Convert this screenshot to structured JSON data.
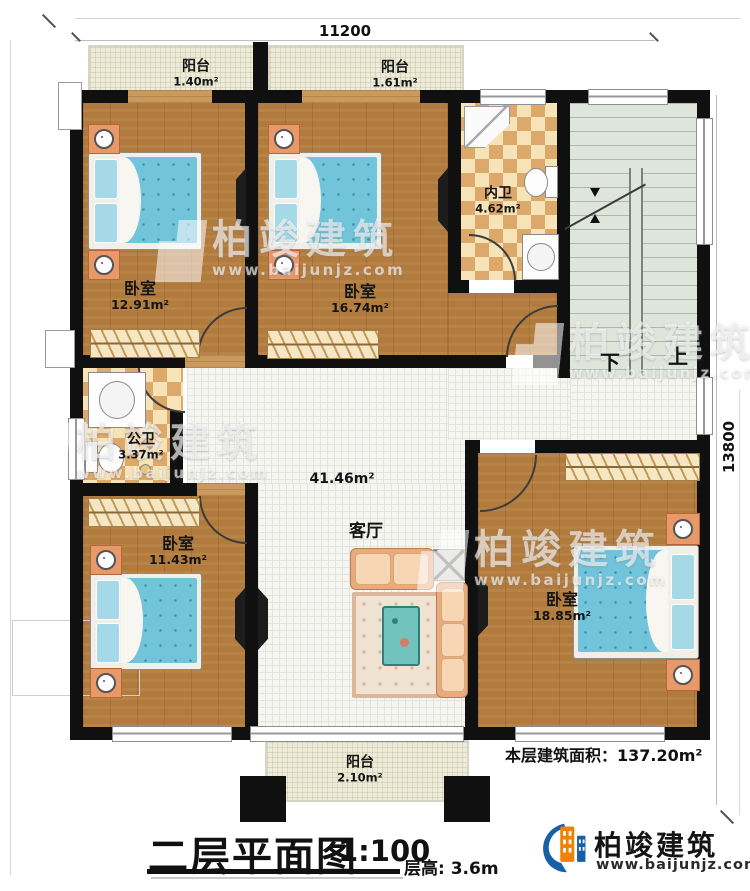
{
  "title_block": {
    "title": "二层平面图",
    "scale": "1:100",
    "floor_height": "层高: 3.6m"
  },
  "area_summary": {
    "label": "本层建筑面积：",
    "value": "137.20m²"
  },
  "dimensions": {
    "top": "11200",
    "right": "13800"
  },
  "brand": {
    "name": "柏竣建筑",
    "site": "www.baijunjz.com",
    "accent_orange": "#f18101",
    "accent_blue": "#1660a8"
  },
  "watermark": {
    "name": "柏竣建筑",
    "site": "www.baijunjz.com"
  },
  "stairs": {
    "down": "下",
    "up": "上"
  },
  "rooms": {
    "balcony1": {
      "name": "阳台",
      "area": "1.40m²"
    },
    "balcony2": {
      "name": "阳台",
      "area": "1.61m²"
    },
    "bedroom1": {
      "name": "卧室",
      "area": "12.91m²"
    },
    "bedroom2": {
      "name": "卧室",
      "area": "16.74m²"
    },
    "inner_bath": {
      "name": "内卫",
      "area": "4.62m²"
    },
    "public_bath": {
      "name": "公卫",
      "area": "3.37m²"
    },
    "bedroom3": {
      "name": "卧室",
      "area": "11.43m²"
    },
    "living": {
      "name": "客厅",
      "area": "41.46m²"
    },
    "bedroom4": {
      "name": "卧室",
      "area": "18.85m²"
    },
    "balcony3": {
      "name": "阳台",
      "area": "2.10m²"
    }
  },
  "colors": {
    "wall": "#101010",
    "wood": "#b27b3e",
    "tile_light": "#f6e3b8",
    "tile_dark": "#dca96a",
    "stair_floor": "#dfe5db",
    "mattress": "#72c4db"
  }
}
